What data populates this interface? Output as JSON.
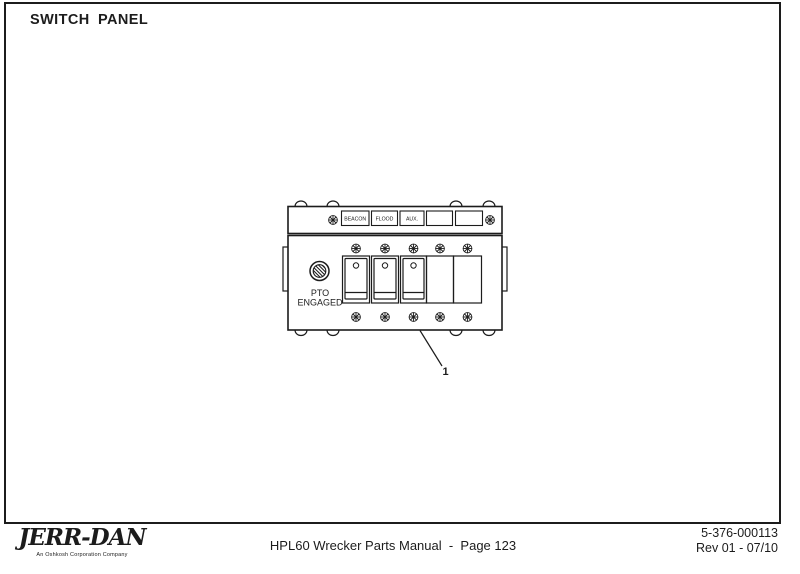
{
  "title": "SWITCH PANEL",
  "diagram": {
    "description": "switch-panel-assembly-drawing",
    "label_plates": [
      "BEACON",
      "FLOOD",
      "AUX.",
      "",
      ""
    ],
    "indicator": {
      "line1": "PTO",
      "line2": "ENGAGED"
    },
    "callout_number": "1"
  },
  "footer": {
    "logo": "JERR-DAN",
    "logo_tagline": "An Oshkosh Corporation Company",
    "center_text": "HPL60 Wrecker Parts Manual  -  Page 123",
    "doc_number": "5-376-000113",
    "revision": "Rev 01 - 07/10"
  },
  "colors": {
    "ink": "#1c1c1c",
    "background": "#ffffff"
  }
}
